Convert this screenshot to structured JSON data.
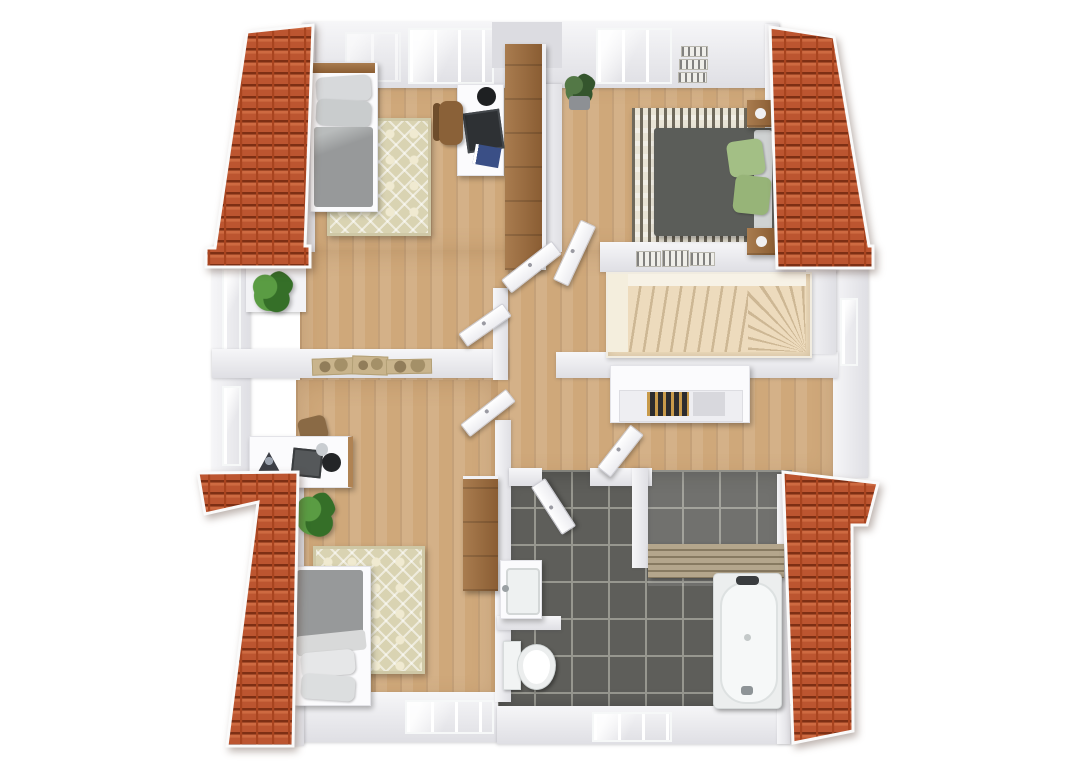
{
  "title": "3D floor plan render – upper storey with four roof slopes",
  "colors": {
    "wall": "#f6f6f8",
    "wall_edge": "#dfdfe4",
    "wood": "#cfa87a",
    "tile": "#5e5e5a",
    "grout": "#97978f",
    "roof_tile": "#bc5530",
    "roof_dark": "#7d2f14",
    "roof_mid": "#a8441f",
    "roof_light": "#ce6a41",
    "stair": "#eddbbd",
    "stair_shadow": "#cdb794",
    "rug_beige": "#d9d3b2",
    "rug_cream": "#f0ead1",
    "rug_gray_base": "#e9e4d6",
    "rug_gray_stripe": "#6f695c",
    "bed_gray": "#97999a",
    "bed_dark": "#5b5d59",
    "pillow_gray": "#d7d9db",
    "pillow_green": "#a3bf85",
    "plant": "#5a9c43",
    "plant_dark": "#356f28",
    "furn_white": "#fbfbfd",
    "wood_furn": "#a97c4f",
    "wood_furn_dark": "#8a5d33",
    "glass": "#e8f0f2",
    "bench_wood": "#b4a68c",
    "bench_gap": "#877a61"
  },
  "scene": {
    "view": "top-down 3d dollhouse floor plan",
    "roof_sections": 4,
    "rooms": [
      {
        "name": "bedroom-top-left",
        "furniture": [
          "single-bed",
          "gray-pillows",
          "diamond-rug",
          "desk",
          "desk-chair",
          "monitor",
          "wardrobe",
          "potted-plant",
          "window-ledge"
        ]
      },
      {
        "name": "bedroom-top-right",
        "furniture": [
          "double-bed",
          "green-pillows",
          "striped-rug",
          "nightstand-left",
          "nightstand-right",
          "wall-pictures",
          "potted-plant",
          "open-door"
        ]
      },
      {
        "name": "hallway",
        "furniture": [
          "open-door-1",
          "open-door-2",
          "open-door-3",
          "wall-art"
        ]
      },
      {
        "name": "stair-landing",
        "furniture": [
          "winder-staircase",
          "sideboard-with-books",
          "open-door"
        ]
      },
      {
        "name": "bedroom-bottom-left",
        "furniture": [
          "single-bed",
          "diamond-rug",
          "desk",
          "monitor",
          "backpack",
          "wardrobe",
          "potted-plant",
          "open-door"
        ]
      },
      {
        "name": "bathroom",
        "furniture": [
          "vanity-sink",
          "toilet",
          "bathtub",
          "wooden-bench",
          "open-door"
        ]
      }
    ]
  }
}
